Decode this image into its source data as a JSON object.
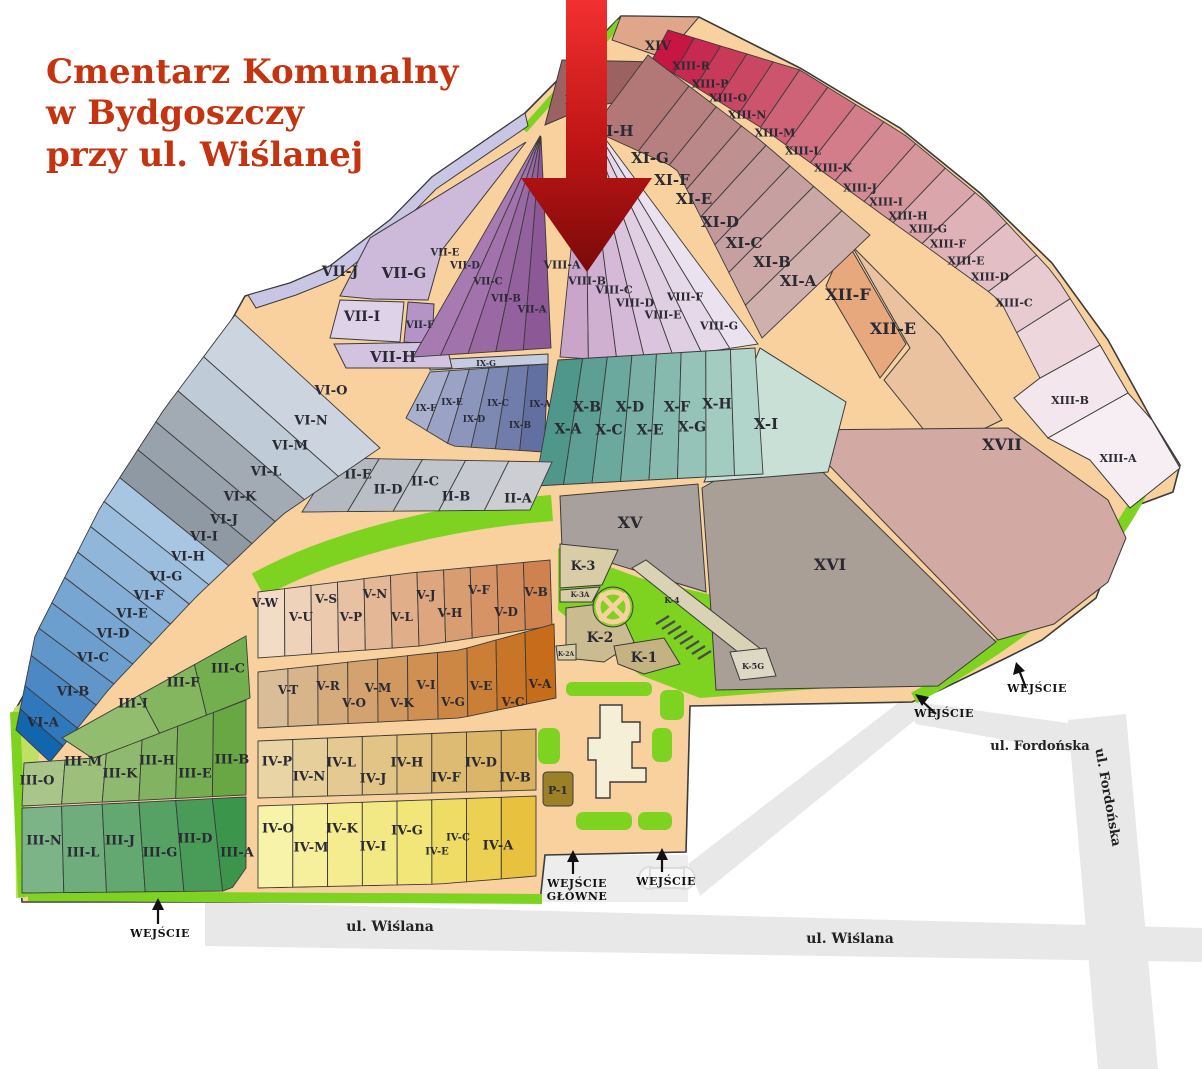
{
  "title": {
    "lines": [
      "Cmentarz Komunalny",
      "w Bydgoszczy",
      "przy ul. Wiślanej"
    ]
  },
  "streets": {
    "wislana": "ul. Wiślana",
    "fordonska": "ul. Fordońska"
  },
  "entrances": {
    "entrance": "WEJŚCIE",
    "main_line1": "WEJŚCIE",
    "main_line2": "GŁÓWNE"
  },
  "sections": {
    "II": [
      "II-A",
      "II-B",
      "II-C",
      "II-D",
      "II-E"
    ],
    "III": [
      "III-A",
      "III-B",
      "III-C",
      "III-D",
      "III-E",
      "III-F",
      "III-G",
      "III-H",
      "III-I",
      "III-J",
      "III-K",
      "III-L",
      "III-M",
      "III-N",
      "III-O"
    ],
    "IV": [
      "IV-A",
      "IV-B",
      "IV-C",
      "IV-D",
      "IV-E",
      "IV-F",
      "IV-G",
      "IV-H",
      "IV-I",
      "IV-J",
      "IV-K",
      "IV-L",
      "IV-M",
      "IV-N",
      "IV-O",
      "IV-P"
    ],
    "V": [
      "V-A",
      "V-B",
      "V-C",
      "V-D",
      "V-E",
      "V-F",
      "V-G",
      "V-H",
      "V-I",
      "V-J",
      "V-K",
      "V-L",
      "V-M",
      "V-N",
      "V-O",
      "V-P",
      "V-R",
      "V-S",
      "V-T",
      "V-U",
      "V-W"
    ],
    "VI": [
      "VI-A",
      "VI-B",
      "VI-C",
      "VI-D",
      "VI-E",
      "VI-F",
      "VI-G",
      "VI-H",
      "VI-I",
      "VI-J",
      "VI-K",
      "VI-L",
      "VI-M",
      "VI-N",
      "VI-O"
    ],
    "VII": [
      "VII-A",
      "VII-B",
      "VII-C",
      "VII-D",
      "VII-E",
      "VII-F",
      "VII-G",
      "VII-H",
      "VII-I",
      "VII-J"
    ],
    "VIII": [
      "VIII-A",
      "VIII-B",
      "VIII-C",
      "VIII-D",
      "VIII-E",
      "VIII-F",
      "VIII-G"
    ],
    "IX": [
      "IX-A",
      "IX-B",
      "IX-C",
      "IX-D",
      "IX-E",
      "IX-F",
      "IX-G"
    ],
    "X": [
      "X-A",
      "X-B",
      "X-C",
      "X-D",
      "X-E",
      "X-F",
      "X-G",
      "X-H",
      "X-I"
    ],
    "XI": [
      "XI-A",
      "XI-B",
      "XI-C",
      "XI-D",
      "XI-E",
      "XI-F",
      "XI-G",
      "XI-H",
      "XI-I"
    ],
    "XII": [
      "XII-E",
      "XII-F"
    ],
    "XIII": [
      "XIII-A",
      "XIII-B",
      "XIII-C",
      "XIII-D",
      "XIII-E",
      "XIII-F",
      "XIII-G",
      "XIII-H",
      "XIII-I",
      "XIII-J",
      "XIII-K",
      "XIII-L",
      "XIII-M",
      "XIII-N",
      "XIII-O",
      "XIII-P",
      "XIII-R"
    ],
    "XIV": "XIV",
    "XV": "XV",
    "XVI": "XVI",
    "XVII": "XVII",
    "K": [
      "K-1",
      "K-2",
      "K-2A",
      "K-3",
      "K-3A",
      "K-4",
      "K-5G"
    ],
    "P": [
      "P-1"
    ]
  },
  "colors": {
    "title": "#c43410",
    "road": "#f8d19e",
    "green": "#7ed321",
    "green_light": "#bfe065",
    "outer_road": "#e8e8e8",
    "arrow_red": "#d41616",
    "border": "#3b3b3b",
    "label": "#2a2a33"
  }
}
